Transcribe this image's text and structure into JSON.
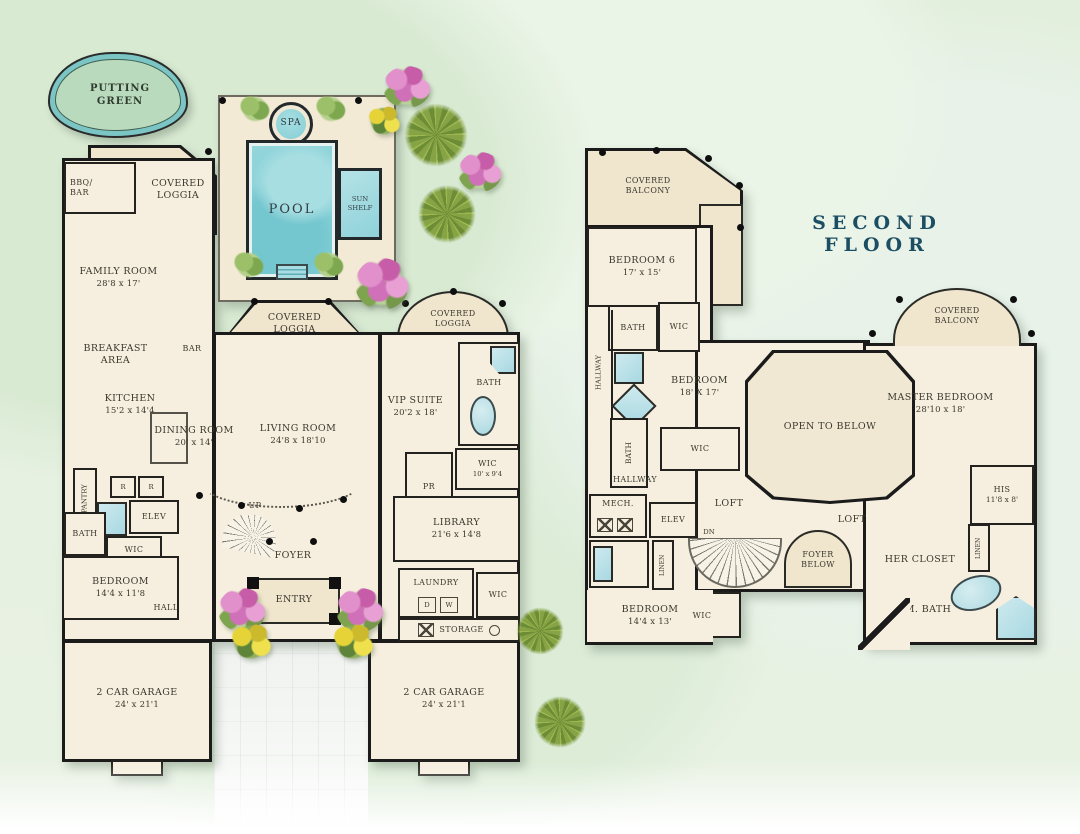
{
  "title": "SECOND FLOOR",
  "site": {
    "putting_green": "PUTTING GREEN",
    "spa": "SPA",
    "pool": "POOL",
    "sun_shelf": "SUN SHELF"
  },
  "first_floor": {
    "bbq_bar": "BBQ/ BAR",
    "covered_loggia_nw": "COVERED LOGGIA",
    "family_room": {
      "name": "FAMILY ROOM",
      "dims": "28'8 x 17'"
    },
    "breakfast_area": "BREAKFAST AREA",
    "kitchen": {
      "name": "KITCHEN",
      "dims": "15'2 x 14'4"
    },
    "bar": "BAR",
    "dining_room": {
      "name": "DINING ROOM",
      "dims": "20' x 14'"
    },
    "living_room": {
      "name": "LIVING ROOM",
      "dims": "24'8 x 18'10"
    },
    "covered_loggia_mid": "COVERED LOGGIA",
    "covered_loggia_east": "COVERED LOGGIA",
    "vip_suite": {
      "name": "VIP SUITE",
      "dims": "20'2 x 18'"
    },
    "vip_bath": "BATH",
    "vip_wic": {
      "name": "WIC",
      "dims": "10' x 9'4"
    },
    "powder_room": "PR",
    "pantry": "PANTRY",
    "fridge_left": "R",
    "fridge_right": "R",
    "elevator": "ELEV",
    "bath": "BATH",
    "wic": "WIC",
    "bedroom": {
      "name": "BEDROOM",
      "dims": "14'4 x 11'8"
    },
    "hall": "HALL",
    "stairs_up": "UP",
    "foyer": "FOYER",
    "entry": "ENTRY",
    "library": {
      "name": "LIBRARY",
      "dims": "21'6 x 14'8"
    },
    "laundry": "LAUNDRY",
    "laundry_dryer": "D",
    "laundry_washer": "W",
    "laundry_wic": "WIC",
    "storage": "STORAGE",
    "garage_left": {
      "name": "2 CAR GARAGE",
      "dims": "24' x 21'1"
    },
    "garage_right": {
      "name": "2 CAR GARAGE",
      "dims": "24' x 21'1"
    }
  },
  "second_floor": {
    "covered_balcony_west": "COVERED BALCONY",
    "bedroom6": {
      "name": "BEDROOM 6",
      "dims": "17' x 15'"
    },
    "bedroom6_bath": "BATH",
    "bedroom6_wic": "WIC",
    "hallway_west": "HALLWAY",
    "bath_center": "BATH",
    "bedroom_center": {
      "name": "BEDROOM",
      "dims": "18' X 17'"
    },
    "bedroom_center_wic": "WIC",
    "hallway_south": "HALLWAY",
    "mech": "MECH.",
    "elevator": "ELEV",
    "linen_west": "LINEN",
    "bedroom_sw": {
      "name": "BEDROOM",
      "dims": "14'4 x 13'"
    },
    "bedroom_sw_wic": "WIC",
    "loft_west": "LOFT",
    "stairs_dn": "DN",
    "foyer_below": "FOYER BELOW",
    "open_to_below": "OPEN TO BELOW",
    "loft_east": "LOFT",
    "master_bedroom": {
      "name": "MASTER BEDROOM",
      "dims": "28'10 x 18'"
    },
    "covered_balcony_east": "COVERED BALCONY",
    "his_closet": {
      "name": "HIS",
      "dims": "11'8 x 8'"
    },
    "her_closet": "HER CLOSET",
    "master_bath": "M. BATH",
    "linen_east": "LINEN"
  },
  "colors": {
    "title_navy": "#1c4e63",
    "wall": "#1b1b1b",
    "room_fill": "#f6efdf",
    "covered_fill": "#f0e5cd",
    "water": "#8ed5da",
    "grass": "#e3efdd",
    "putting_green_fill": "#b9dabc",
    "putting_green_ring": "#7cc5c5"
  }
}
